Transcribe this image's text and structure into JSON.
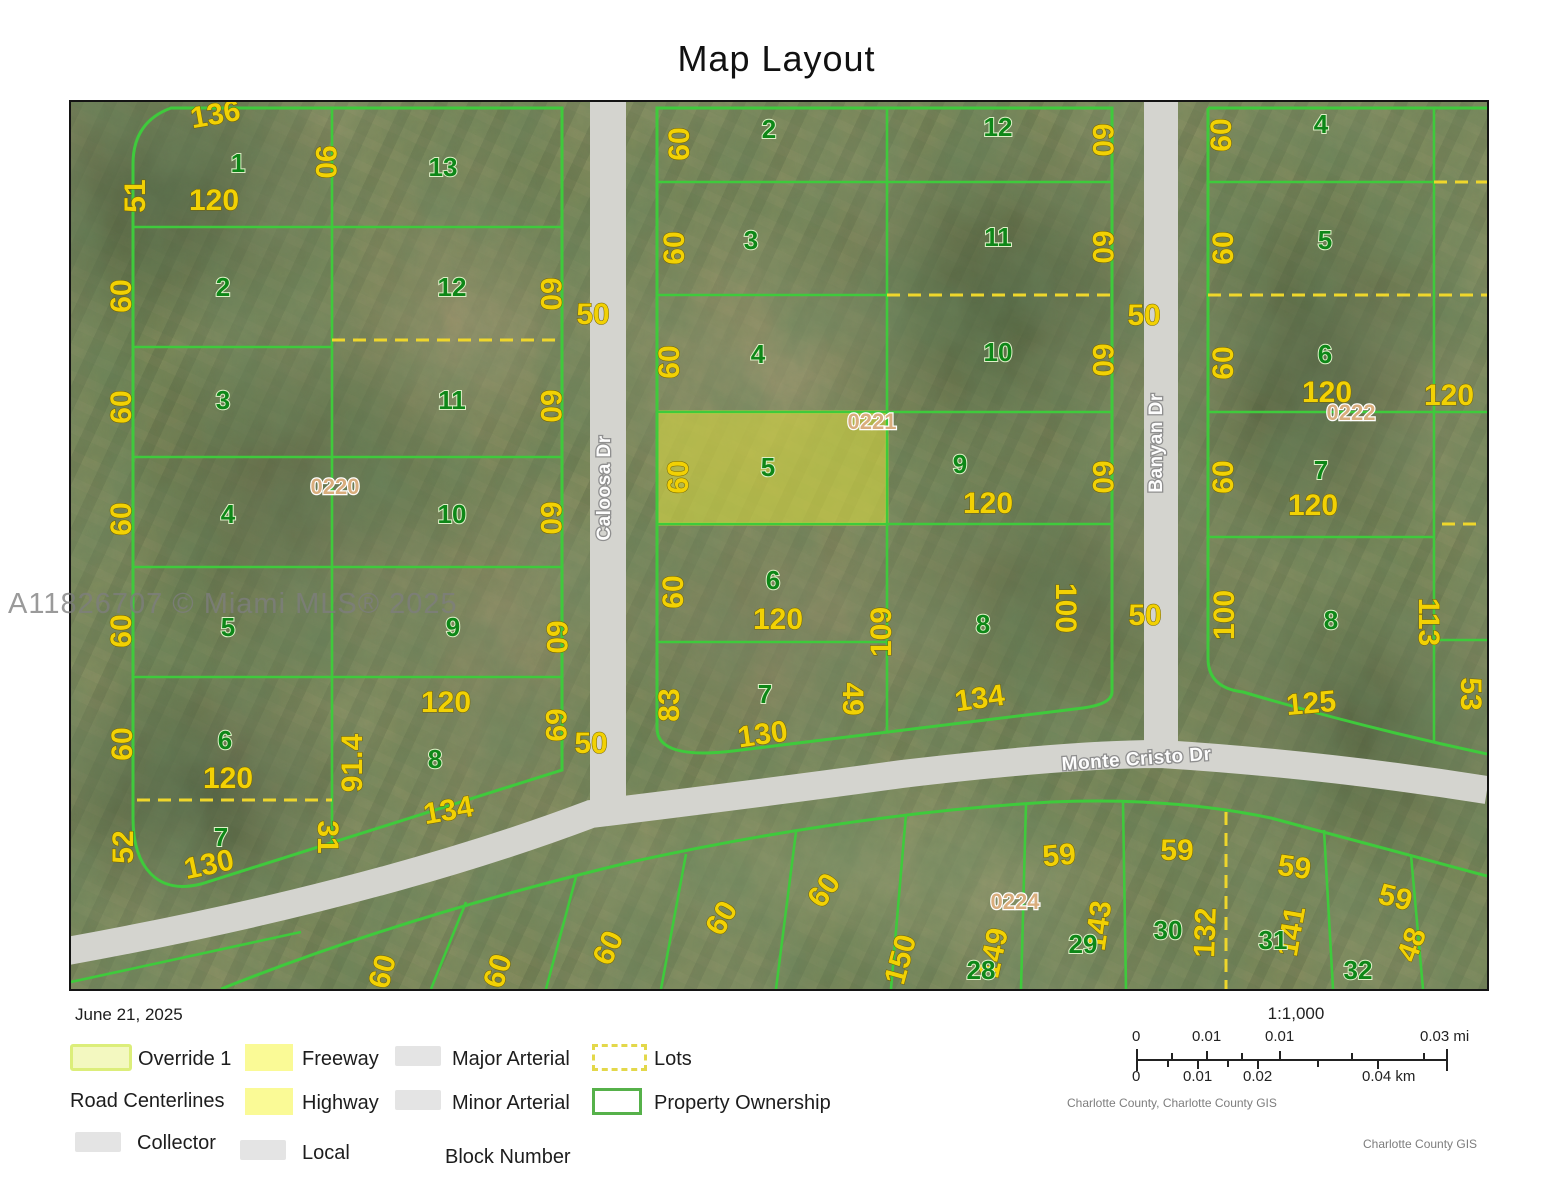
{
  "header": {
    "title": "Map Layout"
  },
  "watermark": "A11826707 © Miami MLS® 2025",
  "colors": {
    "parcel_line": "#3fca3c",
    "lot_dash": "#eed62c",
    "dimension_text": "#f2d104",
    "lot_number_text": "#0e8718",
    "block_number_text": "#d9ad7d",
    "highlight_fill": "#e6e65a",
    "road_fill": "#d4d4cf"
  },
  "map": {
    "streets": [
      "Caloosa Dr",
      "Banyan Dr",
      "Monte Cristo Dr"
    ],
    "blocks": [
      "0220",
      "0221",
      "0222",
      "0224"
    ],
    "highlighted_lot": {
      "block": "0221",
      "lot": "5",
      "width": "60",
      "depth": "120"
    },
    "labels": [
      {
        "t": "136",
        "x": 146,
        "y": 22,
        "r": -10,
        "k": "dim"
      },
      {
        "t": "51",
        "x": 74,
        "y": 94,
        "r": -90,
        "k": "dim"
      },
      {
        "t": "120",
        "x": 143,
        "y": 108,
        "r": 0,
        "k": "dim"
      },
      {
        "t": "90",
        "x": 245,
        "y": 60,
        "r": 90,
        "k": "dim"
      },
      {
        "t": "60",
        "x": 60,
        "y": 194,
        "r": -90,
        "k": "dim"
      },
      {
        "t": "60",
        "x": 470,
        "y": 192,
        "r": 90,
        "k": "dim"
      },
      {
        "t": "60",
        "x": 60,
        "y": 305,
        "r": -90,
        "k": "dim"
      },
      {
        "t": "60",
        "x": 470,
        "y": 304,
        "r": 90,
        "k": "dim"
      },
      {
        "t": "60",
        "x": 60,
        "y": 417,
        "r": -90,
        "k": "dim"
      },
      {
        "t": "60",
        "x": 470,
        "y": 416,
        "r": 90,
        "k": "dim"
      },
      {
        "t": "60",
        "x": 60,
        "y": 529,
        "r": -90,
        "k": "dim"
      },
      {
        "t": "60",
        "x": 476,
        "y": 535,
        "r": 90,
        "k": "dim"
      },
      {
        "t": "60",
        "x": 61,
        "y": 642,
        "r": -90,
        "k": "dim"
      },
      {
        "t": "120",
        "x": 157,
        "y": 686,
        "r": 0,
        "k": "dim"
      },
      {
        "t": "52",
        "x": 62,
        "y": 745,
        "r": -90,
        "k": "dim"
      },
      {
        "t": "130",
        "x": 140,
        "y": 772,
        "r": -12,
        "k": "dim"
      },
      {
        "t": "31",
        "x": 247,
        "y": 735,
        "r": 90,
        "k": "dim"
      },
      {
        "t": "91.4",
        "x": 291,
        "y": 661,
        "r": -90,
        "k": "dim"
      },
      {
        "t": "120",
        "x": 375,
        "y": 610,
        "r": 0,
        "k": "dim"
      },
      {
        "t": "134",
        "x": 379,
        "y": 718,
        "r": -10,
        "k": "dim"
      },
      {
        "t": "69",
        "x": 475,
        "y": 623,
        "r": 90,
        "k": "dim"
      },
      {
        "t": "0220",
        "x": 264,
        "y": 392,
        "r": 0,
        "k": "block"
      },
      {
        "t": "1",
        "x": 167,
        "y": 70,
        "r": 0,
        "k": "lot"
      },
      {
        "t": "13",
        "x": 372,
        "y": 74,
        "r": 0,
        "k": "lot"
      },
      {
        "t": "2",
        "x": 152,
        "y": 194,
        "r": 0,
        "k": "lot"
      },
      {
        "t": "12",
        "x": 381,
        "y": 194,
        "r": 0,
        "k": "lot"
      },
      {
        "t": "3",
        "x": 152,
        "y": 307,
        "r": 0,
        "k": "lot"
      },
      {
        "t": "11",
        "x": 381,
        "y": 307,
        "r": 0,
        "k": "lot"
      },
      {
        "t": "4",
        "x": 157,
        "y": 421,
        "r": 0,
        "k": "lot"
      },
      {
        "t": "10",
        "x": 381,
        "y": 421,
        "r": 0,
        "k": "lot"
      },
      {
        "t": "5",
        "x": 157,
        "y": 534,
        "r": 0,
        "k": "lot"
      },
      {
        "t": "9",
        "x": 382,
        "y": 534,
        "r": 0,
        "k": "lot"
      },
      {
        "t": "6",
        "x": 154,
        "y": 647,
        "r": 0,
        "k": "lot"
      },
      {
        "t": "8",
        "x": 364,
        "y": 666,
        "r": 0,
        "k": "lot"
      },
      {
        "t": "7",
        "x": 150,
        "y": 744,
        "r": 0,
        "k": "lot"
      },
      {
        "t": "60",
        "x": 618,
        "y": 42,
        "r": -90,
        "k": "dim"
      },
      {
        "t": "60",
        "x": 1022,
        "y": 38,
        "r": 90,
        "k": "dim"
      },
      {
        "t": "60",
        "x": 613,
        "y": 146,
        "r": -90,
        "k": "dim"
      },
      {
        "t": "60",
        "x": 1022,
        "y": 145,
        "r": 90,
        "k": "dim"
      },
      {
        "t": "60",
        "x": 608,
        "y": 260,
        "r": -90,
        "k": "dim"
      },
      {
        "t": "60",
        "x": 1022,
        "y": 258,
        "r": 90,
        "k": "dim"
      },
      {
        "t": "60",
        "x": 617,
        "y": 375,
        "r": -90,
        "k": "dim"
      },
      {
        "t": "60",
        "x": 1022,
        "y": 375,
        "r": 90,
        "k": "dim"
      },
      {
        "t": "120",
        "x": 917,
        "y": 411,
        "r": 0,
        "k": "dim"
      },
      {
        "t": "60",
        "x": 612,
        "y": 490,
        "r": -90,
        "k": "dim"
      },
      {
        "t": "120",
        "x": 707,
        "y": 527,
        "r": 0,
        "k": "dim"
      },
      {
        "t": "109",
        "x": 820,
        "y": 530,
        "r": -90,
        "k": "dim"
      },
      {
        "t": "100",
        "x": 985,
        "y": 506,
        "r": 90,
        "k": "dim"
      },
      {
        "t": "134",
        "x": 910,
        "y": 606,
        "r": -8,
        "k": "dim"
      },
      {
        "t": "83",
        "x": 608,
        "y": 603,
        "r": -90,
        "k": "dim"
      },
      {
        "t": "49",
        "x": 772,
        "y": 597,
        "r": 90,
        "k": "dim"
      },
      {
        "t": "130",
        "x": 693,
        "y": 642,
        "r": -8,
        "k": "dim"
      },
      {
        "t": "0221",
        "x": 801,
        "y": 327,
        "r": 0,
        "k": "block"
      },
      {
        "t": "2",
        "x": 698,
        "y": 36,
        "r": 0,
        "k": "lot"
      },
      {
        "t": "12",
        "x": 927,
        "y": 34,
        "r": 0,
        "k": "lot"
      },
      {
        "t": "3",
        "x": 680,
        "y": 147,
        "r": 0,
        "k": "lot"
      },
      {
        "t": "11",
        "x": 927,
        "y": 144,
        "r": 0,
        "k": "lot"
      },
      {
        "t": "4",
        "x": 687,
        "y": 261,
        "r": 0,
        "k": "lot"
      },
      {
        "t": "10",
        "x": 927,
        "y": 259,
        "r": 0,
        "k": "lot"
      },
      {
        "t": "5",
        "x": 697,
        "y": 374,
        "r": 0,
        "k": "lot"
      },
      {
        "t": "9",
        "x": 889,
        "y": 371,
        "r": 0,
        "k": "lot"
      },
      {
        "t": "6",
        "x": 702,
        "y": 487,
        "r": 0,
        "k": "lot"
      },
      {
        "t": "8",
        "x": 912,
        "y": 531,
        "r": 0,
        "k": "lot"
      },
      {
        "t": "7",
        "x": 694,
        "y": 601,
        "r": 0,
        "k": "lot"
      },
      {
        "t": "60",
        "x": 1160,
        "y": 33,
        "r": -90,
        "k": "dim"
      },
      {
        "t": "60",
        "x": 1162,
        "y": 146,
        "r": -90,
        "k": "dim"
      },
      {
        "t": "60",
        "x": 1162,
        "y": 261,
        "r": -90,
        "k": "dim"
      },
      {
        "t": "120",
        "x": 1256,
        "y": 300,
        "r": 0,
        "k": "dim"
      },
      {
        "t": "120",
        "x": 1378,
        "y": 303,
        "r": 0,
        "k": "dim"
      },
      {
        "t": "0222",
        "x": 1280,
        "y": 318,
        "r": 0,
        "k": "block"
      },
      {
        "t": "60",
        "x": 1162,
        "y": 375,
        "r": -90,
        "k": "dim"
      },
      {
        "t": "120",
        "x": 1242,
        "y": 413,
        "r": 0,
        "k": "dim"
      },
      {
        "t": "100",
        "x": 1163,
        "y": 513,
        "r": -90,
        "k": "dim"
      },
      {
        "t": "113",
        "x": 1348,
        "y": 520,
        "r": 90,
        "k": "dim"
      },
      {
        "t": "125",
        "x": 1241,
        "y": 611,
        "r": -5,
        "k": "dim"
      },
      {
        "t": "53",
        "x": 1390,
        "y": 592,
        "r": 90,
        "k": "dim"
      },
      {
        "t": "4",
        "x": 1250,
        "y": 31,
        "r": 0,
        "k": "lot"
      },
      {
        "t": "5",
        "x": 1254,
        "y": 147,
        "r": 0,
        "k": "lot"
      },
      {
        "t": "6",
        "x": 1254,
        "y": 261,
        "r": 0,
        "k": "lot"
      },
      {
        "t": "7",
        "x": 1250,
        "y": 377,
        "r": 0,
        "k": "lot"
      },
      {
        "t": "8",
        "x": 1260,
        "y": 527,
        "r": 0,
        "k": "lot"
      },
      {
        "t": "50",
        "x": 522,
        "y": 222,
        "r": 0,
        "k": "rdim"
      },
      {
        "t": "50",
        "x": 520,
        "y": 651,
        "r": 0,
        "k": "rdim"
      },
      {
        "t": "50",
        "x": 1073,
        "y": 223,
        "r": 0,
        "k": "rdim"
      },
      {
        "t": "50",
        "x": 1074,
        "y": 523,
        "r": 0,
        "k": "rdim"
      },
      {
        "t": "Caloosa Dr",
        "x": 539,
        "y": 386,
        "r": -90,
        "k": "road"
      },
      {
        "t": "Banyan Dr",
        "x": 1091,
        "y": 341,
        "r": -90,
        "k": "road"
      },
      {
        "t": "Monte Cristo Dr",
        "x": 1066,
        "y": 663,
        "r": -4,
        "k": "road"
      },
      {
        "t": "60",
        "x": 321,
        "y": 872,
        "r": -75,
        "k": "dim"
      },
      {
        "t": "60",
        "x": 436,
        "y": 872,
        "r": -72,
        "k": "dim"
      },
      {
        "t": "60",
        "x": 546,
        "y": 850,
        "r": -65,
        "k": "dim"
      },
      {
        "t": "60",
        "x": 659,
        "y": 821,
        "r": -60,
        "k": "dim"
      },
      {
        "t": "60",
        "x": 761,
        "y": 794,
        "r": -55,
        "k": "dim"
      },
      {
        "t": "59",
        "x": 989,
        "y": 763,
        "r": -5,
        "k": "dim"
      },
      {
        "t": "59",
        "x": 1106,
        "y": 758,
        "r": 0,
        "k": "dim"
      },
      {
        "t": "59",
        "x": 1222,
        "y": 775,
        "r": 8,
        "k": "dim"
      },
      {
        "t": "59",
        "x": 1322,
        "y": 805,
        "r": 14,
        "k": "dim"
      },
      {
        "t": "150",
        "x": 839,
        "y": 860,
        "r": -75,
        "k": "dim"
      },
      {
        "t": "149",
        "x": 932,
        "y": 853,
        "r": -78,
        "k": "dim"
      },
      {
        "t": "143",
        "x": 1037,
        "y": 825,
        "r": -82,
        "k": "dim"
      },
      {
        "t": "132",
        "x": 1144,
        "y": 831,
        "r": -88,
        "k": "dim"
      },
      {
        "t": "141",
        "x": 1230,
        "y": 831,
        "r": -80,
        "k": "dim"
      },
      {
        "t": "48",
        "x": 1350,
        "y": 846,
        "r": -70,
        "k": "dim"
      },
      {
        "t": "0224",
        "x": 944,
        "y": 807,
        "r": 0,
        "k": "block"
      },
      {
        "t": "28",
        "x": 910,
        "y": 877,
        "r": 0,
        "k": "lot"
      },
      {
        "t": "29",
        "x": 1012,
        "y": 851,
        "r": 0,
        "k": "lot"
      },
      {
        "t": "30",
        "x": 1097,
        "y": 837,
        "r": 0,
        "k": "lot"
      },
      {
        "t": "31",
        "x": 1202,
        "y": 847,
        "r": 0,
        "k": "lot"
      },
      {
        "t": "32",
        "x": 1287,
        "y": 877,
        "r": 0,
        "k": "lot"
      }
    ]
  },
  "legend": {
    "date": "June 21, 2025",
    "override": "Override 1",
    "freeway": "Freeway",
    "major": "Major Arterial",
    "lots": "Lots",
    "road_centerlines": "Road Centerlines",
    "highway": "Highway",
    "minor": "Minor Arterial",
    "ownership": "Property Ownership",
    "collector": "Collector",
    "local": "Local",
    "block_number": "Block Number"
  },
  "scalebar": {
    "ratio": "1:1,000",
    "mi": [
      "0",
      "0.01",
      "0.01",
      "0.03 mi"
    ],
    "km": [
      "0",
      "0.01",
      "0.02",
      "0.04 km"
    ],
    "attr1": "Charlotte County, Charlotte County GIS",
    "attr2": "Charlotte County GIS"
  }
}
